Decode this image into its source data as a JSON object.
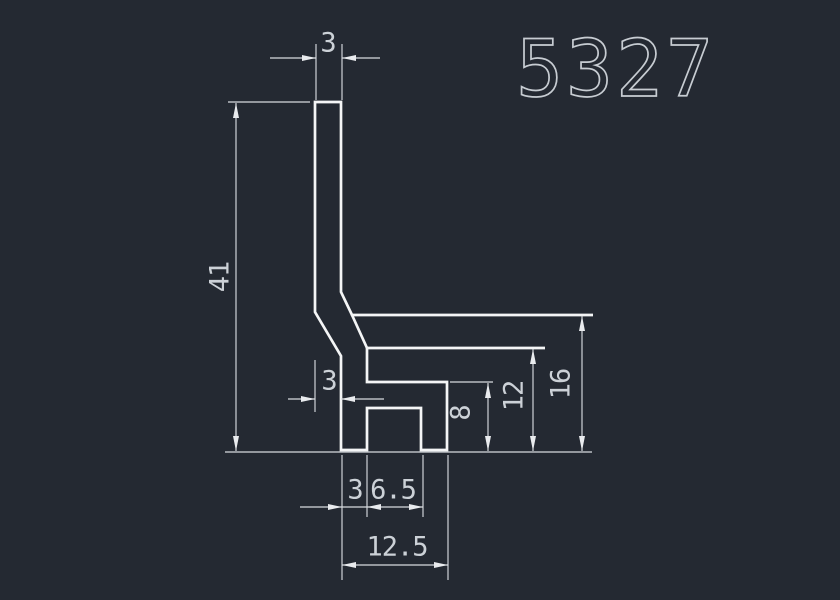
{
  "drawing": {
    "title": "5327",
    "colors": {
      "background": "#242932",
      "profile_line": "#f4f5f6",
      "dimension_line": "#d7dadf",
      "dimension_text": "#ccd1d7",
      "title_text": "#c7ccd2"
    },
    "dims": {
      "top_wall_thickness": "3",
      "overall_height": "41",
      "mid_offset": "3",
      "arm_height": "8",
      "flange_underside_height": "12",
      "flange_top_height": "16",
      "foot_width": "3",
      "slot_width": "6.5",
      "base_width": "12.5"
    }
  }
}
